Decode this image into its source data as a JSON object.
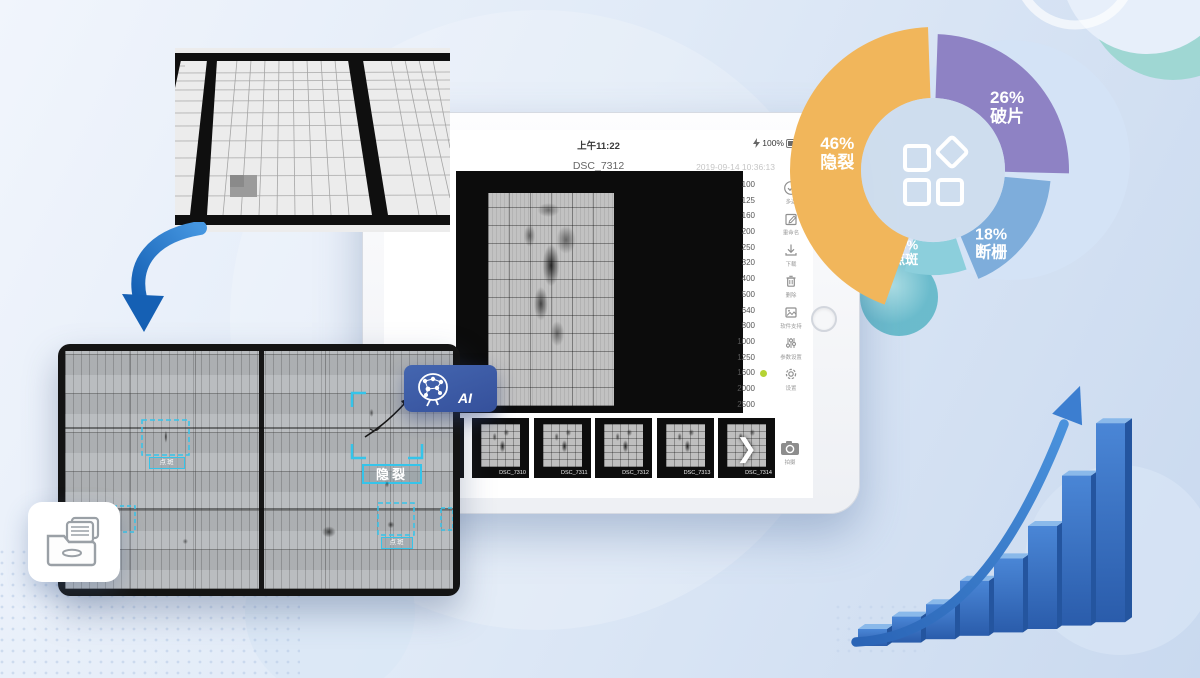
{
  "tablet": {
    "status_bar": {
      "network": "4G",
      "time": "上午11:22",
      "battery": "100%"
    },
    "filename": "DSC_7312",
    "timestamp": "2019-09-14 10:36:13",
    "iso": {
      "values": [
        "100",
        "125",
        "160",
        "200",
        "250",
        "320",
        "400",
        "500",
        "640",
        "800",
        "1000",
        "1250",
        "1600",
        "2000",
        "2500"
      ],
      "selected": "1600"
    },
    "tools": [
      {
        "icon": "check-circle-icon",
        "label": "多选"
      },
      {
        "icon": "rename-icon",
        "label": "重命名"
      },
      {
        "icon": "download-icon",
        "label": "下载"
      },
      {
        "icon": "trash-icon",
        "label": "删除"
      },
      {
        "icon": "image-icon",
        "label": "软件支持"
      },
      {
        "icon": "sliders-icon",
        "label": "参数设置"
      },
      {
        "icon": "gear-icon",
        "label": "设置"
      }
    ],
    "thumbnails": [
      "DSC_7310",
      "DSC_7311",
      "DSC_7312",
      "DSC_7313",
      "DSC_7314"
    ],
    "camera_label": "拍摄"
  },
  "ai_badge": {
    "label": "AI"
  },
  "detections": [
    {
      "label": "隐裂"
    },
    {
      "label": "点斑"
    },
    {
      "label": "点斑"
    }
  ],
  "chart_data": [
    {
      "type": "pie",
      "style": "donut",
      "unit": "%",
      "segments": [
        {
          "label": "隐裂",
          "value": 46,
          "color": "#F1B65B"
        },
        {
          "label": "破片",
          "value": 26,
          "color": "#8E82C4"
        },
        {
          "label": "断栅",
          "value": 18,
          "color": "#7EADDB"
        },
        {
          "label": "点斑",
          "value": 10,
          "color": "#8CCFDC"
        }
      ],
      "center_icon": "grid-shapes-icon",
      "legend_position": "on-slices"
    },
    {
      "type": "bar",
      "values": [
        17,
        26,
        35,
        55,
        74,
        103,
        150,
        199
      ],
      "color": "#3B76C9",
      "annotations": [
        "upward-curved-growth-arrow"
      ]
    }
  ]
}
